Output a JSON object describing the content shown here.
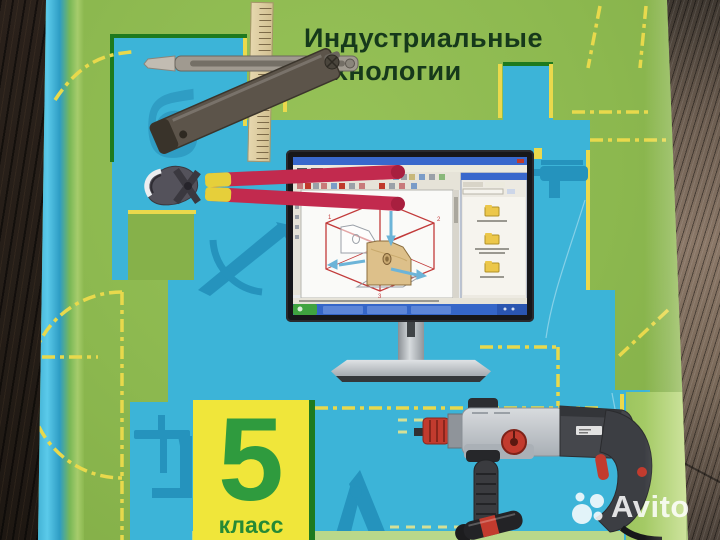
{
  "watermark": {
    "brand": "Avito"
  },
  "cover": {
    "title_line1": "Индустриальные",
    "title_line2": "технологии",
    "grade": {
      "number": "5",
      "word": "класс"
    },
    "background_letter": "б",
    "cad_plane_labels": [
      "1",
      "2",
      "3"
    ],
    "colors": {
      "cover_green": "#8cb84f",
      "panel_blue": "#3cb4d8",
      "silhouette_blue": "#2593bd",
      "accent_yellow": "#ead94c",
      "border_dark_green": "#1e7a1e",
      "grade_square_yellow": "#f0e63a",
      "grade_number_green": "#2f9b3e",
      "title_green": "#16391b",
      "spine_cyan": "#49c2e3",
      "tool_handle_red": "#c22a4e"
    },
    "illustrations": [
      "sliding-bevel-gauge",
      "wooden-ruler",
      "pincers",
      "computer-monitor-with-cad-software",
      "hammer-drill",
      "screwdriver"
    ]
  }
}
